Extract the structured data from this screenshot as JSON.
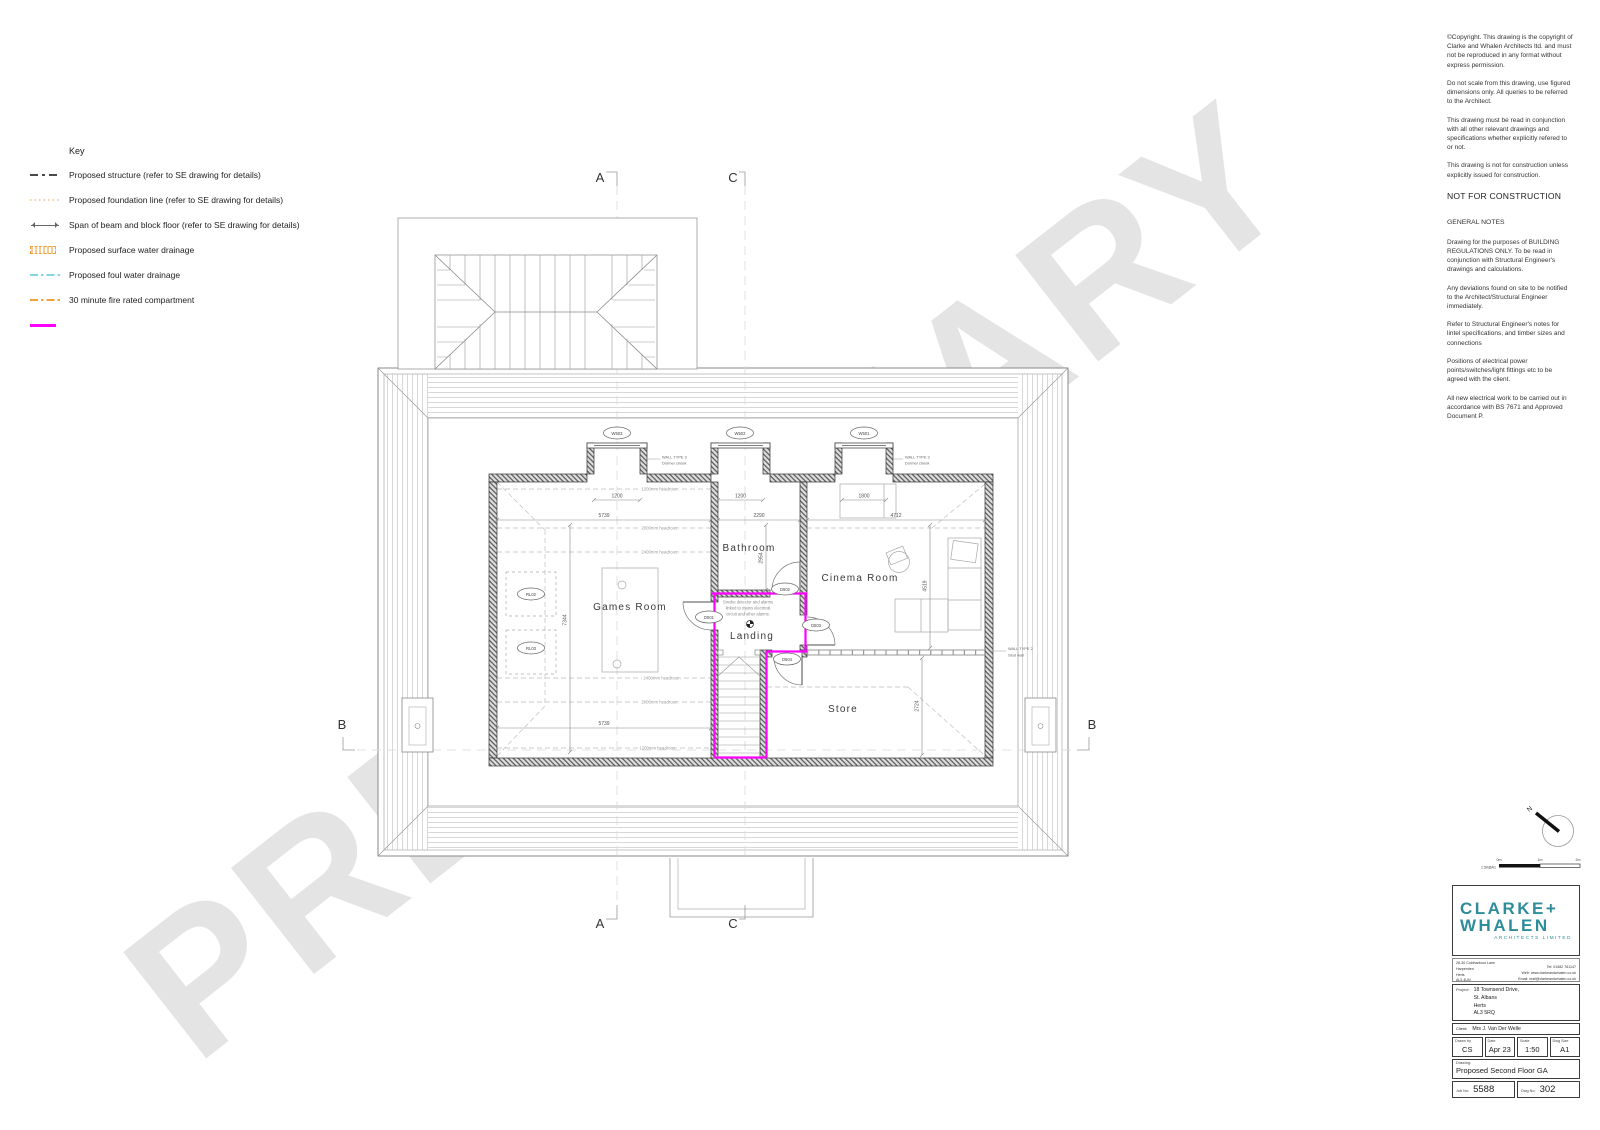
{
  "watermark": "PRELIMINARY",
  "colors": {
    "fire_magenta": "#ff00ff",
    "drainage_orange": "#f0a23c",
    "foul_cyan": "#85d4e6",
    "foundation_peach": "#f3cfa4",
    "logo_teal": "#2e8d9a",
    "watermark_gray": "#e4e4e4"
  },
  "key": {
    "title": "Key",
    "items": [
      {
        "label": "Proposed structure (refer to SE drawing for details)"
      },
      {
        "label": "Proposed foundation line (refer to SE drawing for details)"
      },
      {
        "label": "Span of beam and block floor (refer to SE drawing for details)"
      },
      {
        "label": "Proposed surface water drainage"
      },
      {
        "label": "Proposed foul water drainage"
      },
      {
        "label": "30 minute fire rated compartment"
      },
      {
        "label": ""
      }
    ]
  },
  "notes": {
    "paragraphs": [
      "©Copyright. This drawing is the copyright of Clarke and Whalen Architects ltd. and must not be reproduced in any format without express permission.",
      "Do not scale from this drawing, use figured dimensions only. All queries to be referred to the Architect.",
      "This drawing must be read in conjunction with all other relevant drawings and specifications whether explicitly refered to or not.",
      "This drawing is not for construction unless explicitly issued for construction."
    ],
    "not_for_construction": "NOT FOR CONSTRUCTION",
    "general_title": "GENERAL NOTES",
    "general": [
      "Drawing for the purposes of BUILDING REGULATIONS ONLY. To be read in conjunction with Structural Engineer's drawings and calculations.",
      "Any deviations found on site to be notified to the Architect/Structural Engineer immediately.",
      "Refer to Structural Engineer's notes for lintel specifications, and timber sizes and connections",
      "Positions of electrical power points/switches/light fittings etc to be agreed with the client.",
      "All new electrical work to be carried out in accordance with BS 7671 and Approved Document P."
    ]
  },
  "plan": {
    "rooms": [
      "Games Room",
      "Bathroom",
      "Cinema Room",
      "Landing",
      "Store"
    ],
    "windows": [
      "W503",
      "W502",
      "W501"
    ],
    "doors": [
      "D501",
      "D502",
      "D503",
      "D504"
    ],
    "rooflights": [
      "RL02",
      "RL03"
    ],
    "dims": [
      "1200",
      "1200",
      "1800",
      "5739",
      "2290",
      "4712",
      "2954",
      "4519",
      "7344",
      "5739",
      "2724"
    ],
    "headrooms_top": [
      "1200mm headroom",
      "2000mm headroom",
      "2400mm headroom"
    ],
    "headrooms_bottom": [
      "2400mm headroom",
      "2000mm headroom",
      "1200mm headroom"
    ],
    "wall_type3": {
      "line1": "WALL TYPE 3",
      "line2": "Dormer cheek"
    },
    "wall_type2": {
      "line1": "WALL TYPE 2",
      "line2": "Stud wall"
    },
    "smoke_note": [
      "Smoke detector and alarms",
      "linked to mains electrical",
      "circuit and other alarms."
    ],
    "sections": {
      "a": "A",
      "b": "B",
      "c": "C"
    },
    "north": "N"
  },
  "scalebar": {
    "label": "1:50@A1",
    "t0": "0m",
    "t1": "1m",
    "t2": "2m"
  },
  "titleblock": {
    "logo_line1": "CLARKE+",
    "logo_line2": "WHALEN",
    "logo_sub": "ARCHITECTS LIMITED",
    "address": {
      "l1": "28-30 Coldharbour Lane",
      "l2": "Harpenden",
      "l3": "Herts",
      "l4": "AL5 4UN"
    },
    "contact": {
      "l1": "Tel: 01582 761147",
      "l2": "Web: www.clarkeandwhalen.co.uk",
      "l3": "Email: mail@clarkeandwhalen.co.uk"
    },
    "project_label": "Project:",
    "project": {
      "l1": "18 Townsend Drive,",
      "l2": "St. Albans",
      "l3": "Herts",
      "l4": "AL3 5RQ"
    },
    "client_label": "Client:",
    "client": "Mrs J. Van Der Welle",
    "fields": [
      {
        "label": "Drawn by",
        "value": "CS"
      },
      {
        "label": "Date",
        "value": "Apr 23"
      },
      {
        "label": "Scale",
        "value": "1:50"
      },
      {
        "label": "Dwg Size",
        "value": "A1"
      }
    ],
    "drawing_label": "Drawing:",
    "drawing": "Proposed Second Floor GA",
    "job_label": "Job No:",
    "job": "5588",
    "dwg_label": "Dwg No:",
    "dwg": "302"
  }
}
